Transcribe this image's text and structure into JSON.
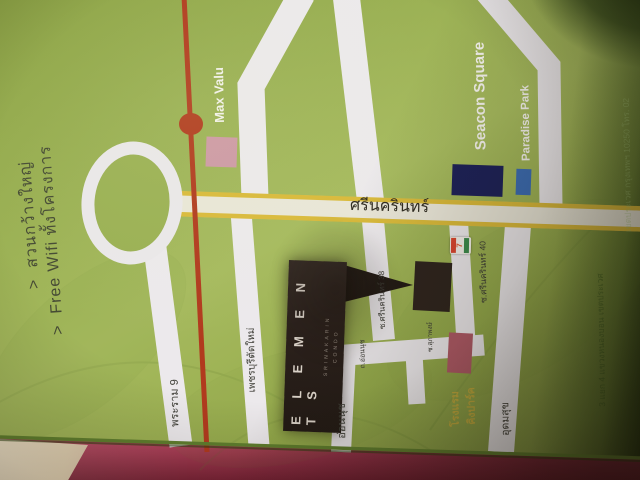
{
  "promo": {
    "bullet_char": ">",
    "bullets": [
      {
        "text": "สวนกว้างใหญ่"
      },
      {
        "text": "Free Wifi ทั้งโครงการ"
      }
    ]
  },
  "map": {
    "main_road_label": "ศรีนครินทร์",
    "landmarks": {
      "max_valu": "Max Valu",
      "seacon_square": "Seacon Square",
      "paradise_park": "Paradise Park",
      "hotel_line1": "โรงแรม",
      "hotel_line2": "คิงปาร์ค",
      "seven_eleven_glyph": "7"
    },
    "roads": {
      "rama9": "พระราม 9",
      "new_phetchaburi": "เพชรบุรีตัดใหม่",
      "on_nut": "อ่อนนุช",
      "on_nut_small": "ถ.อ่อนนุช",
      "udom_suk": "อุดมสุข",
      "soi_38": "ซ.ศรีนครินทร์ 38",
      "soi_40": "ซ.ศรีนครินทร์ 40",
      "soi_supapong": "ซ.สุภาพงษ์"
    },
    "logo": {
      "name": "ELEMENTS",
      "sub1": "SRINAKARIN",
      "sub2": "CONDO"
    },
    "address_faint_line1": "3 แยก 4 แขวงหนองบอน เขตประเวศ",
    "address_faint_line2": "เขตประเวศ กรุงเทพฯ 10250 โทร. 02"
  },
  "colors": {
    "page_green": "#9ab053",
    "road_white": "#ece9ec",
    "road_yellow": "#d9b93a",
    "route_red": "#b13a1e",
    "seacon_navy": "#1d2158",
    "paradise_blue": "#3b6cb3",
    "maxvalu_pink": "#cd98a5",
    "hotel_pink": "#b05a67",
    "logo_brown": "#2a201b",
    "table_pink": "#c84f6b"
  }
}
